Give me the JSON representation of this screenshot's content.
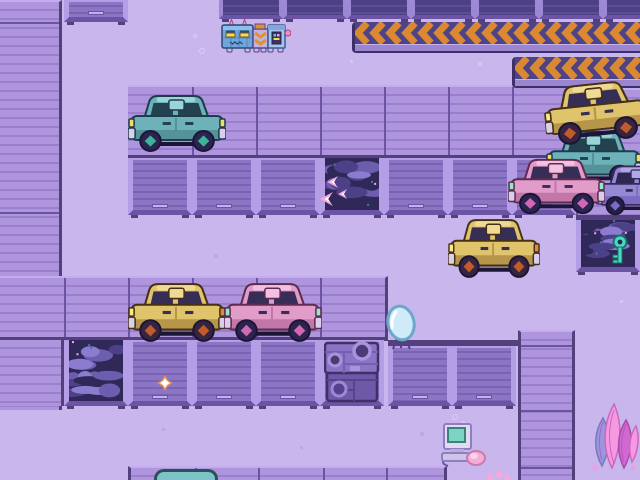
{
  "app": {
    "type": "game-screenshot",
    "description": "Top-down pixel-art junkyard garage scene: purple lot with roller garage doors, hazard chevron barriers, junked cars, water-filled bays and a caterpillar robot"
  },
  "palette": {
    "floor": "#c9b6ec",
    "speckLight": "#dccbf6",
    "speckDark": "#b7a3de",
    "stripeBase": "#ae95de",
    "stripeLine": "#9a80cc",
    "stripeTopEdge": "#c3adee",
    "seam": "#6b54a4",
    "darkEdge": "#53417e",
    "lintel": "#53417e",
    "doorFrame": "#b49ee6",
    "doorShutter": "#8d75c6",
    "doorSlat": "#7a63b2",
    "doorHandle": "#c3b0ee",
    "doorSill": "#6b54a4",
    "darkDoorShutter": "#4d4084",
    "darkDoorSlat": "#5c4e96",
    "darkDoorFrame": "#9e88d4",
    "waterBase": "#2f2858",
    "waterWave1": "#4c4188",
    "waterWave2": "#6c5dae",
    "waterWave3": "#8b7cd0",
    "waterFleck": "#3e7d92",
    "sparklePink": "#f6a8dc",
    "sparkleWhite": "#ffffff",
    "sparkleOrange": "#e8924a",
    "chevronBg": "#4f4388",
    "chevronOrange": "#d98932",
    "chevronLedge": "#9b85cf",
    "chevronDark": "#3c3069",
    "keyTeal": "#4ed8c2",
    "keyDark": "#17706a"
  },
  "carPalettes": {
    "teal": {
      "body": "#6cb2b8",
      "shade": "#549499",
      "roof": "#9ad4d6",
      "window": "#24424e",
      "light": "#f2dc5a",
      "light2": "#f2dc5a",
      "bumper": "#d9cfec",
      "wheel": "#2c2450",
      "hub": "#3cb49a",
      "outline": "#1e3c50"
    },
    "yellow": {
      "body": "#e0c46c",
      "shade": "#b7964a",
      "roof": "#efd994",
      "window": "#362e56",
      "light": "#f6ea80",
      "light2": "#e08648",
      "bumper": "#d9cfec",
      "wheel": "#382440",
      "hub": "#c05c2c",
      "outline": "#443014"
    },
    "pink": {
      "body": "#e29cca",
      "shade": "#c377a9",
      "roof": "#f2c0e0",
      "window": "#362e56",
      "light": "#97e6c9",
      "light2": "#97e6c9",
      "bumper": "#d9cfec",
      "wheel": "#2c2450",
      "hub": "#cf6ab2",
      "outline": "#5e2c50"
    },
    "purple": {
      "body": "#9488d4",
      "shade": "#7a6cc0",
      "roof": "#b2a8e6",
      "window": "#2e2850",
      "light": "#f2dc5a",
      "light2": "#f2dc5a",
      "bumper": "#d9cfec",
      "wheel": "#241e44",
      "hub": "#7a6cc4",
      "outline": "#35295e"
    }
  },
  "entities": {
    "robot": {
      "label": "caterpillar-robot-npc",
      "x": 221,
      "y": 19,
      "w": 70,
      "h": 35
    },
    "cars": [
      {
        "id": "car-stack-teal",
        "label": "junked teal car (stacked)",
        "palette": "teal",
        "x": 546,
        "y": 128,
        "w": 96,
        "h": 60,
        "z": 31
      },
      {
        "id": "car-stack-yellow",
        "label": "junked yellow car on stack",
        "palette": "yellow",
        "x": 544,
        "y": 80,
        "w": 104,
        "h": 64,
        "z": 32,
        "rot": -6
      },
      {
        "id": "car-purple-edge",
        "label": "junked purple car (clipped)",
        "palette": "purple",
        "x": 596,
        "y": 163,
        "w": 84,
        "h": 54,
        "z": 31
      },
      {
        "id": "car-stack-pink",
        "label": "junked pink car (front)",
        "palette": "pink",
        "x": 508,
        "y": 156,
        "w": 97,
        "h": 60,
        "z": 33
      },
      {
        "id": "car-teal-parked",
        "label": "teal car parked at doors",
        "palette": "teal",
        "x": 128,
        "y": 92,
        "w": 98,
        "h": 62,
        "z": 30
      },
      {
        "id": "car-yellow-right",
        "label": "yellow car center-right",
        "palette": "yellow",
        "x": 448,
        "y": 216,
        "w": 92,
        "h": 64,
        "z": 30
      },
      {
        "id": "car-yellow-left",
        "label": "yellow car middle-left",
        "palette": "yellow",
        "x": 128,
        "y": 280,
        "w": 98,
        "h": 64,
        "z": 30
      },
      {
        "id": "car-pink-left",
        "label": "pink car middle-left",
        "palette": "pink",
        "x": 224,
        "y": 280,
        "w": 98,
        "h": 64,
        "z": 30
      }
    ],
    "items": [
      {
        "id": "key",
        "label": "teal key in water tank",
        "x": 610,
        "y": 234,
        "w": 20,
        "h": 32,
        "z": 14
      },
      {
        "id": "mirror",
        "label": "standing oval mirror",
        "x": 382,
        "y": 304,
        "w": 38,
        "h": 48,
        "z": 30
      },
      {
        "id": "crate",
        "label": "junked machinery crate",
        "x": 324,
        "y": 340,
        "w": 56,
        "h": 64,
        "z": 40
      },
      {
        "id": "computer",
        "label": "retro computer with mouse",
        "x": 440,
        "y": 410,
        "w": 46,
        "h": 58,
        "z": 30
      },
      {
        "id": "plant",
        "label": "pink-purple crystal plant",
        "x": 588,
        "y": 400,
        "w": 52,
        "h": 72,
        "z": 30
      }
    ],
    "sparkles": [
      {
        "id": "arrow-1",
        "x": 327,
        "y": 176,
        "s": 12
      },
      {
        "id": "arrow-2",
        "x": 320,
        "y": 192,
        "s": 14
      },
      {
        "id": "arrow-3",
        "x": 338,
        "y": 189,
        "s": 10
      },
      {
        "id": "star-1",
        "x": 157,
        "y": 375,
        "s": 16
      }
    ],
    "bubbles": [
      {
        "x": 452,
        "y": 414,
        "r": 3
      },
      {
        "x": 461,
        "y": 421,
        "r": 2
      },
      {
        "x": 447,
        "y": 424,
        "r": 2
      },
      {
        "x": 193,
        "y": 34,
        "r": 2
      },
      {
        "x": 199,
        "y": 48,
        "r": 3
      }
    ],
    "speckles": [
      {
        "x": 478,
        "y": 62,
        "c": "light",
        "r": 4
      },
      {
        "x": 592,
        "y": 106,
        "c": "light",
        "r": 4
      },
      {
        "x": 598,
        "y": 148,
        "c": "light",
        "r": 3
      },
      {
        "x": 303,
        "y": 190,
        "c": "dark",
        "r": 4
      },
      {
        "x": 341,
        "y": 199,
        "c": "dark",
        "r": 3
      },
      {
        "x": 214,
        "y": 254,
        "c": "dark",
        "r": 4
      },
      {
        "x": 238,
        "y": 300,
        "c": "dark",
        "r": 3
      },
      {
        "x": 420,
        "y": 432,
        "c": "dark",
        "r": 4
      },
      {
        "x": 300,
        "y": 446,
        "c": "dark",
        "r": 3
      },
      {
        "x": 162,
        "y": 428,
        "c": "dark",
        "r": 3
      },
      {
        "x": 586,
        "y": 166,
        "c": "light",
        "r": 3
      },
      {
        "x": 620,
        "y": 300,
        "c": "light",
        "r": 3
      },
      {
        "x": 350,
        "y": 60,
        "c": "light",
        "r": 3
      },
      {
        "x": 252,
        "y": 336,
        "c": "dark",
        "r": 3
      }
    ]
  },
  "structures": {
    "door_rows": [
      {
        "id": "top-door-single",
        "x": 64,
        "y": 0,
        "bays": "d",
        "h": 22,
        "variant": "light"
      },
      {
        "id": "top-door-row",
        "x": 219,
        "y": 0,
        "bays": "d,d,d,d,d,d,d",
        "h": 19,
        "variant": "dark"
      },
      {
        "id": "upper-door-row",
        "x": 128,
        "y": 158,
        "bays": "d,d,d,w,d,d,d",
        "h": 57,
        "variant": "light"
      },
      {
        "id": "lower-door-row",
        "x": 64,
        "y": 340,
        "bays": "w,d,d,d,d",
        "h": 66,
        "variant": "light"
      },
      {
        "id": "right-door-row",
        "x": 388,
        "y": 346,
        "bays": "d,d",
        "h": 60,
        "variant": "light"
      }
    ],
    "barriers": [
      {
        "id": "barrier-top",
        "x": 352,
        "y": 22,
        "w": 288,
        "h": 31
      },
      {
        "id": "barrier-lower",
        "x": 512,
        "y": 57,
        "w": 128,
        "h": 31
      }
    ],
    "key_tank": {
      "x": 576,
      "y": 222,
      "w": 64,
      "h": 56
    }
  }
}
